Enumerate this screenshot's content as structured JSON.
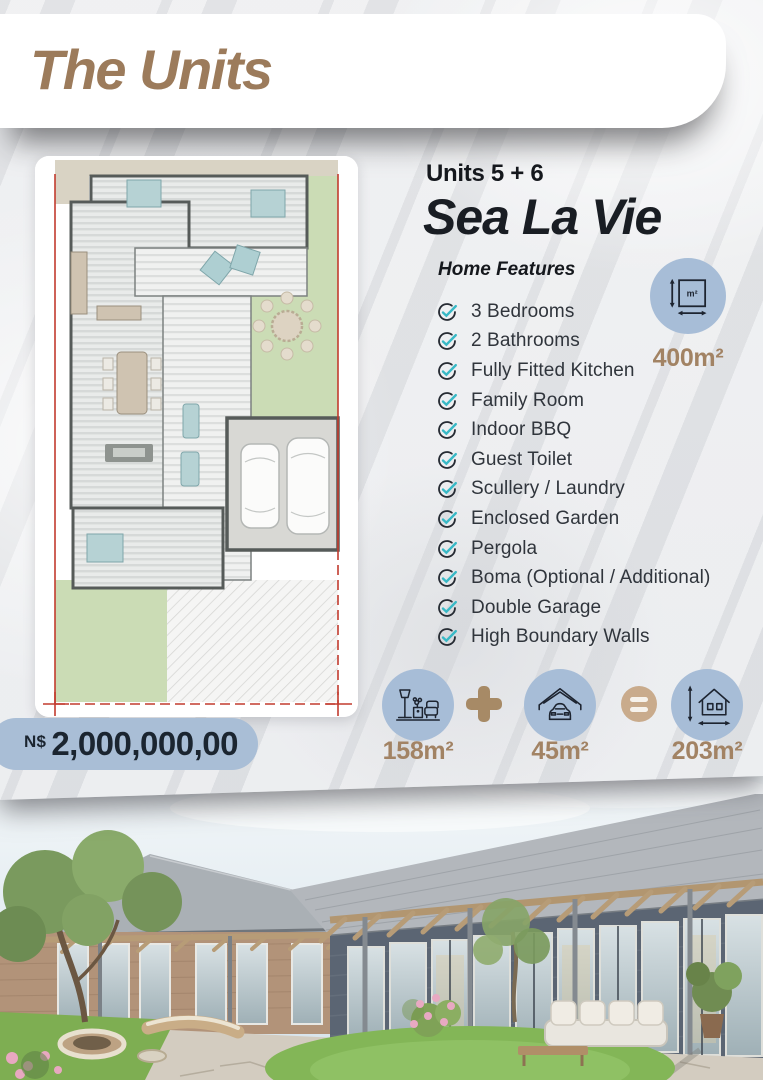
{
  "header": {
    "title": "The Units"
  },
  "unit": {
    "label": "Units 5 + 6",
    "name": "Sea La Vie"
  },
  "features": {
    "heading": "Home Features",
    "items": [
      "3 Bedrooms",
      "2 Bathrooms",
      "Fully Fitted Kitchen",
      "Family Room",
      "Indoor BBQ",
      "Guest Toilet",
      "Scullery / Laundry",
      "Enclosed Garden",
      "Pergola",
      "Boma (Optional / Additional)",
      "Double Garage",
      "High Boundary Walls"
    ]
  },
  "stand_size": {
    "value": "400m²"
  },
  "price": {
    "currency": "N$",
    "amount": "2,000,000,00"
  },
  "area_equation": {
    "interior": "158m²",
    "plus_symbol": "+",
    "garage": "45m²",
    "equals_symbol": "=",
    "total": "203m²"
  },
  "colors": {
    "accent_brown": "#9c7b5b",
    "label_brown": "#a28364",
    "badge_blue": "#a7bdd7",
    "pill_blue": "#a9bed6",
    "check_teal": "#38b9c6",
    "text_dark": "#1d2228"
  }
}
